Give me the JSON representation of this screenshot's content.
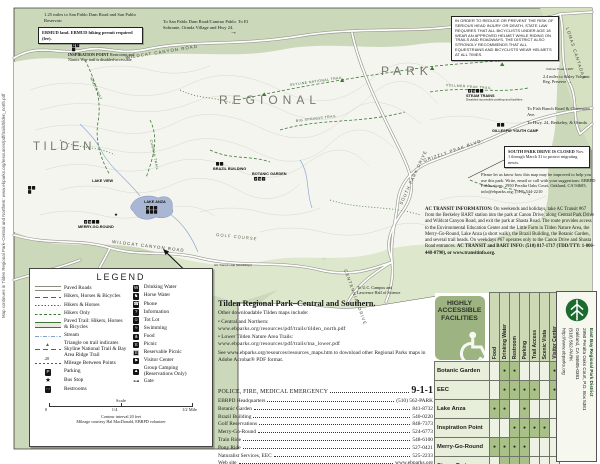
{
  "page": {
    "left_edge_caption": "Map continues in Tilden Regional Park–Central and Northern: www.ebparks.org/resources/pdf/trails/tilden_north.pdf"
  },
  "icons": {
    "arrow_right": "→"
  },
  "map": {
    "park_words": {
      "w1": "TILDEN",
      "w2": "REGIONAL",
      "w3": "PARK"
    },
    "roads": {
      "wildcat_top": "WILDCAT CANYON ROAD",
      "wildcat_bottom": "WILDCAT CANYON ROAD",
      "grizzly": "GRIZZLY PEAK BLVD.",
      "centennial": "CENTENNIAL DRIVE",
      "lomas": "LOMAS CANTADAS",
      "south_park": "SOUTH PARK DRIVE",
      "golf": "GOLF COURSE"
    },
    "trails": {
      "nimitz": "NIMITZ WAY",
      "seaview": "SEA VIEW TRAIL",
      "skyline": "SKYLINE NATIONAL TRAIL",
      "vollmer": "VOLLMER PEAK TRAIL",
      "big_springs": "BIG SPRINGS TRAIL",
      "curran": "CURRAN TRAIL"
    },
    "places": {
      "lake_anza": "LAKE ANZA",
      "lake_view": "LAKE VIEW",
      "merry_go_round": "MERRY-GO-ROUND",
      "botanic_garden": "BOTANIC GARDEN",
      "brazil_building": "BRAZIL BUILDING",
      "steam_trains": "STEAM TRAINS",
      "steam_note": "Disabled-accessible parking and facilities",
      "gillespie": "GILLESPIE YOUTH CAMP",
      "vollmer_peak": "Vollmer Peak 1,905'",
      "ac_stop": "AC Transit stop (weekdays)"
    },
    "notes": {
      "san_pablo": "1.25 miles to San Pablo Dam Road and San Pablo Reservoir",
      "ebmud": "EBMUD land. EBMUD hiking permit required (fee).",
      "to_san_pablo": "To San Pablo Dam Road/Camino Pablo.",
      "to_el_sobrante": "To El Sobrante, Orinda Village and Hwy 24.",
      "inspiration_title": "INSPIRATION POINT",
      "inspiration_body": "Restrooms and Nimitz Way trail is disabled-accessible",
      "helmet": "In order to reduce or prevent the risk of serious head injury or death, state law requires that all bicyclists under age 18 wear an approved helmet while riding on trails and roadways. The District also strongly recommends that all equestrians and bicyclists wear helmets at all times.",
      "sibley": "2.4 miles to Sibley Volcanic Reg. Preserve",
      "fish_ranch": "To Fish Ranch Road & Claremont Ave.",
      "hwy24": "To Hwy. 24, Berkeley, & Orinda",
      "south_park_closed_1": "SOUTH PARK DRIVE IS CLOSED",
      "south_park_closed_2": "Nov. 1 through March 31 to protect migrating newts.",
      "improve": "Please let us know how this map may be improved to help you use this park. Write, email or call with your suggestions: EBRPD Publications, 2950 Peralta Oaks Court, Oakland, CA 94605; info@ebparks.org; (510) 544-2210",
      "ac_lead": "AC TRANSIT INFORMATION:",
      "ac_body": " On weekends and holidays, take AC Transit #67 from the Berkeley BART station into the park at Canon Drive, along Central Park Drive and Wildcat Canyon Road, and exit the park at Shasta Road. The route provides access to the Environmental Education Center and the Little Farm in Tilden Nature Area, the Merry-Go-Round, Lake Anza (a short walk), the Brazil Building, the Botanic Garden, and several trail heads. On weekdays #67 operates only to the Canon Drive and Shasta Road entrances. ",
      "ac_tail": "AC TRANSIT and BART INFO: (510) 817-1717 (TDD/TTY: 1-800-448-0790), or www.transitinfo.org.",
      "uc_campus": "To U.C. Campus and Lawrence Hall of Science"
    }
  },
  "legend": {
    "title": "LEGEND",
    "left": [
      {
        "label": "Paved Roads"
      },
      {
        "label": "Hikers, Horses & Bicycles"
      },
      {
        "label": "Hikers & Horses"
      },
      {
        "label": "Hikers Only"
      },
      {
        "label": "Paved Trail: Hikers, Horses & Bicycles"
      },
      {
        "label": "Stream"
      },
      {
        "label": "Triangle on trail indicates Skyline National Trail & Bay Area Ridge Trail",
        "icon": "▲"
      },
      {
        "label": "Mileage Between Points",
        "value": ".20"
      },
      {
        "label": "Parking",
        "icon": "P"
      },
      {
        "label": "Bus Stop",
        "icon": "★"
      },
      {
        "label": "Restrooms",
        "icon": "♀♂"
      }
    ],
    "right": [
      {
        "label": "Drinking Water",
        "icon": "W"
      },
      {
        "label": "Horse Water",
        "icon": "♞"
      },
      {
        "label": "Phone",
        "icon": "☎"
      },
      {
        "label": "Information",
        "icon": "?"
      },
      {
        "label": "Tot Lot",
        "icon": "☺"
      },
      {
        "label": "Swimming",
        "icon": "≈"
      },
      {
        "label": "Food",
        "icon": "⋔"
      },
      {
        "label": "Picnic",
        "icon": "π"
      },
      {
        "label": "Reservable Picnic",
        "icon": "π"
      },
      {
        "label": "Visitor Center",
        "icon": "⚑"
      },
      {
        "label": "Group Camping (Reservations Only)",
        "icon": "▲"
      },
      {
        "label": "Gate",
        "icon": "⊶"
      }
    ],
    "scale": {
      "label": "Scale",
      "t0": "0",
      "t1": "1/4",
      "t2": "1/2 Mile"
    },
    "footnote1": "Contour interval 20 feet",
    "footnote2": "Mileage courtesy Hal MacDonald, EBRPD volunteer"
  },
  "info": {
    "title": "Tilden Regional Park–Central and Southern.",
    "intro": "Other downloadable Tilden maps include:",
    "bullet1_name": "• Central and Northern:",
    "bullet1_url": "www.ebparks.org/resources/pdf/trails/tilden_north.pdf",
    "bullet2_name": "• Lower Tilden Nature Area Trails:",
    "bullet2_url": "www.ebparks.org/resources/pdf/trails/tna_lower.pdf",
    "see": "See www.ebparks.org/resources/resources_maps.htm to download other Regional Parks maps in Adobe Acrobat® PDF format."
  },
  "directory": {
    "rows": [
      {
        "label": "POLICE, FIRE, MEDICAL EMERGENCY",
        "value": "9-1-1"
      },
      {
        "label": "EBRPD Headquarters",
        "value": "(510) 562-PARK"
      },
      {
        "label": "Botanic Garden",
        "value": "841-8732"
      },
      {
        "label": "Brazil Building",
        "value": "540-0220"
      },
      {
        "label": "Golf Reservations",
        "value": "848-7373"
      },
      {
        "label": "Merry-Go-Round",
        "value": "524-6773"
      },
      {
        "label": "Train Ride",
        "value": "548-6100"
      },
      {
        "label": "Pony Ride",
        "value": "527-0421"
      },
      {
        "label": "Naturalist Services, EEC",
        "value": "525-2233"
      },
      {
        "label": "Web site",
        "value": "www.ebparks.org"
      }
    ]
  },
  "access_table": {
    "title": "HIGHLY ACCESSIBLE FACILITIES",
    "columns": [
      "Food",
      "Drinking Water",
      "Restroom",
      "Parking",
      "Trail Access",
      "Scenic Vista",
      "Visitor Center"
    ],
    "rows": [
      {
        "label": "Botanic Garden",
        "cells": [
          "",
          "●",
          "●",
          "",
          "",
          "",
          "●"
        ]
      },
      {
        "label": "EEC",
        "cells": [
          "",
          "●",
          "●",
          "●",
          "●",
          "",
          "●"
        ]
      },
      {
        "label": "Lake Anza",
        "cells": [
          "●",
          "●",
          "",
          "●",
          "",
          "",
          ""
        ]
      },
      {
        "label": "Inspiration Point",
        "cells": [
          "",
          "",
          "●",
          "●",
          "●",
          "●",
          ""
        ]
      },
      {
        "label": "Merry-Go-Round",
        "cells": [
          "●",
          "●",
          "●",
          "●",
          "",
          "",
          ""
        ]
      },
      {
        "label": "Steam Trains",
        "cells": [
          "",
          "●",
          "●",
          "●",
          "",
          "",
          ""
        ]
      }
    ]
  },
  "district": {
    "name": "East Bay Regional Park District",
    "address": "2950 Peralta Oaks Court, P.O. Box 5381",
    "city": "Oakland, CA 94605-0381",
    "phone": "(510) 562-PARK",
    "web": "http://www.ebparks.org"
  }
}
